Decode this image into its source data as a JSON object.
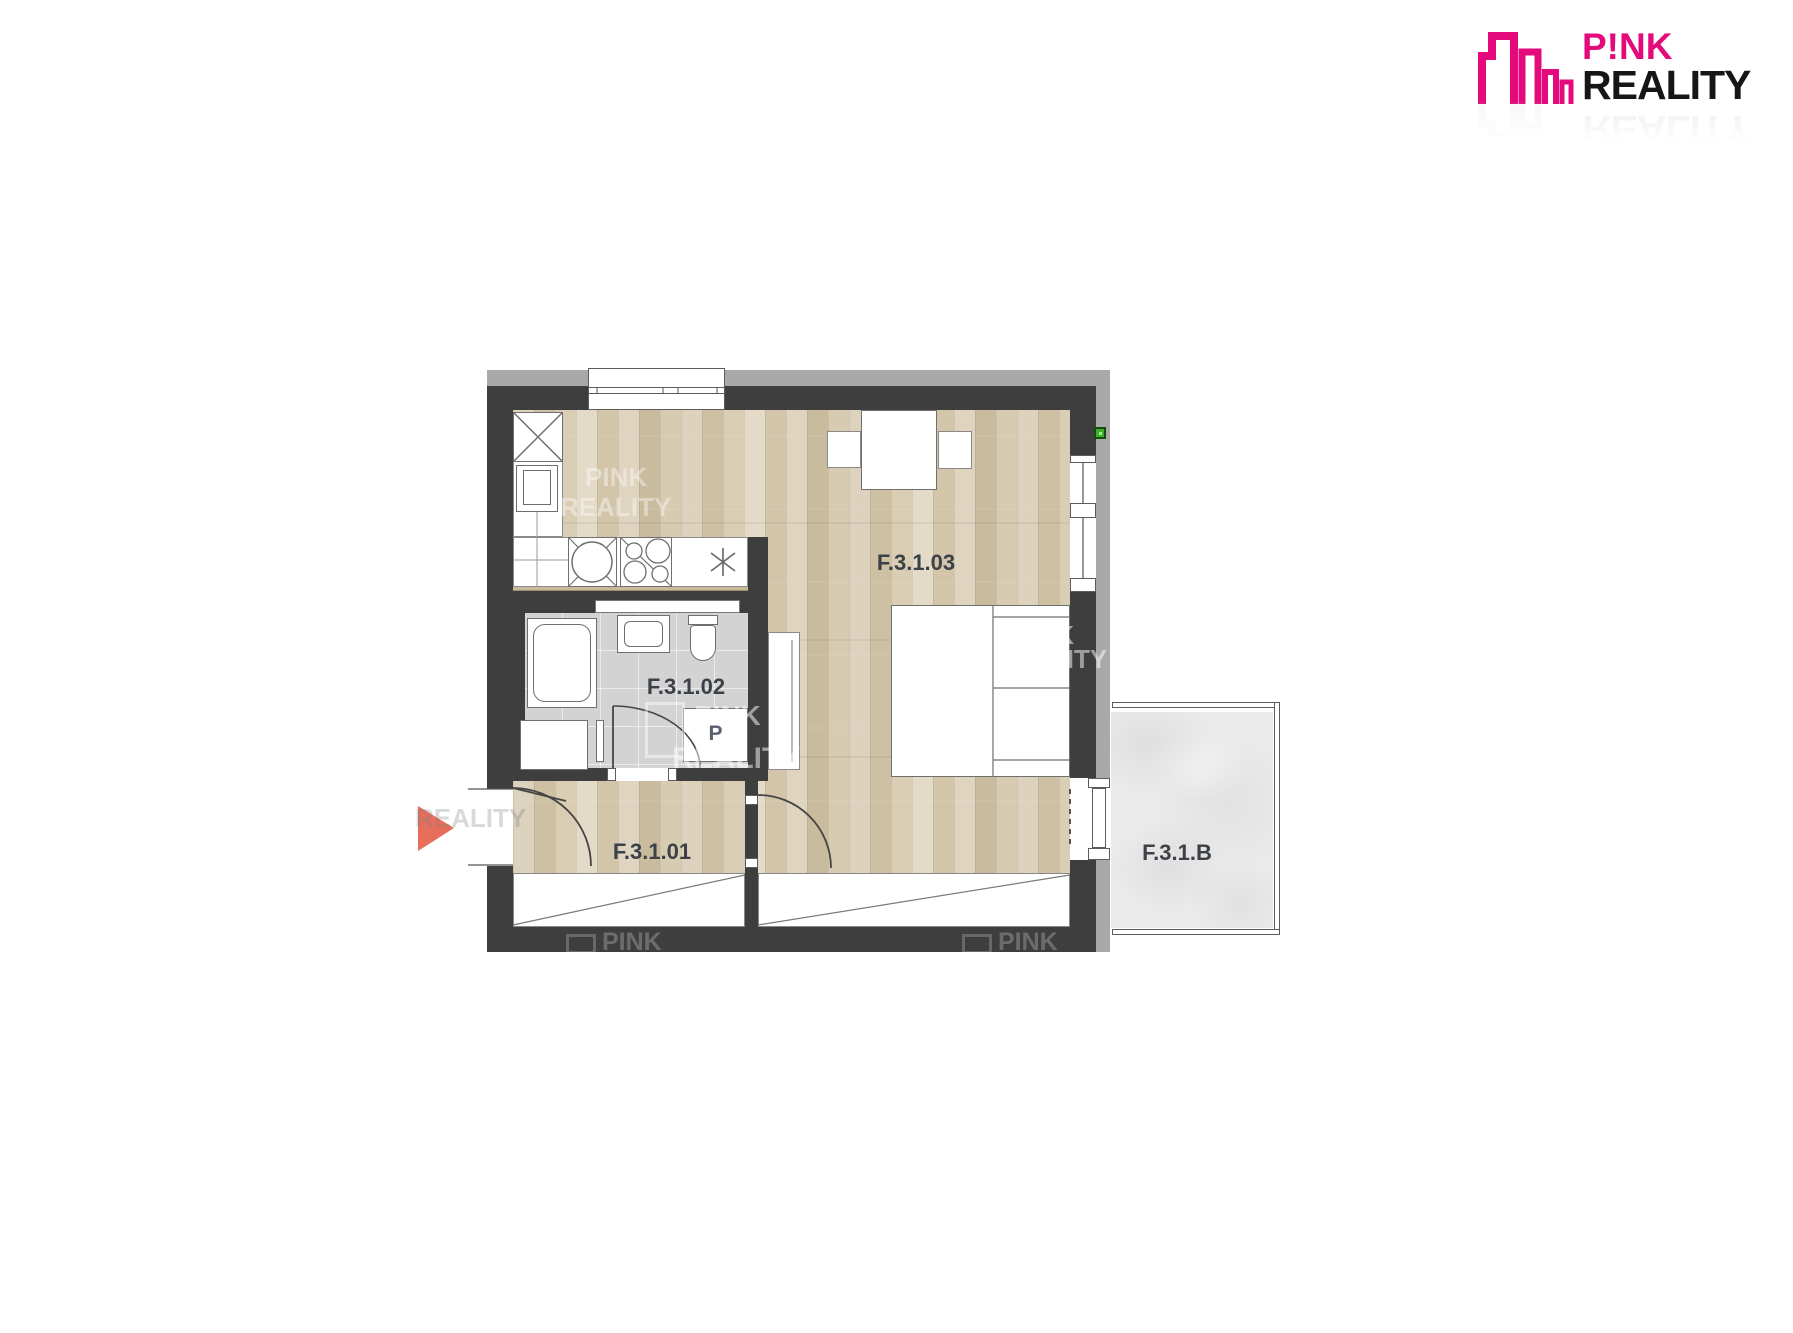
{
  "logo": {
    "brand_line1": "P!NK",
    "brand_line2": "REALITY"
  },
  "rooms": {
    "hallway": "F.3.1.01",
    "bathroom": "F.3.1.02",
    "living": "F.3.1.03",
    "balcony": "F.3.1.B"
  },
  "fixtures": {
    "washing_machine": "P"
  },
  "watermark": {
    "word1": "PINK",
    "word2": "REALITY"
  },
  "colors": {
    "wall": "#3e3e3e",
    "outer_edge": "#a9a9a9",
    "wood_floor": "#d8cdb5",
    "bathroom_tile": "#d3d3d3",
    "balcony_concrete": "#ebebeb",
    "brand_pink": "#e40a7b",
    "entrance_arrow": "#e66e5a",
    "utility_marker_green": "#3fae2a",
    "room_label_text": "#3c4148"
  }
}
